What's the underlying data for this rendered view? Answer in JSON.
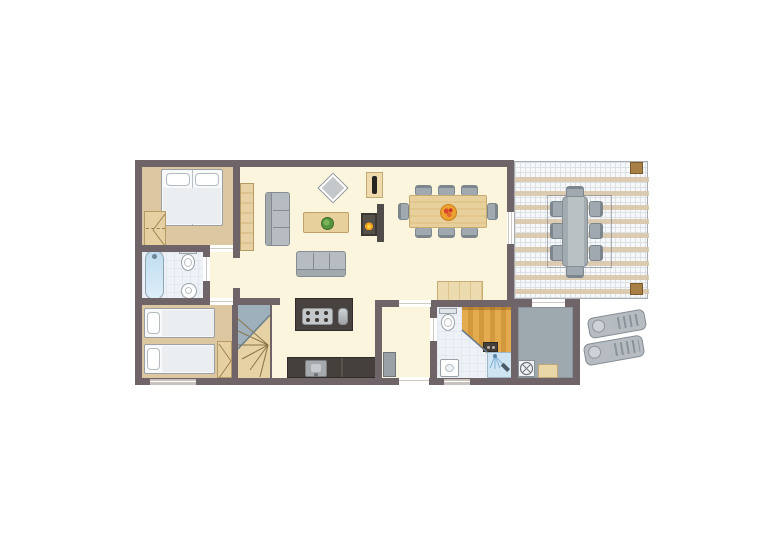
{
  "scene": "holiday-home-floor-plan",
  "visible_text": [],
  "colors": {
    "wall": "#6f6568",
    "floor": "#fcf5dd",
    "floor_tan": "#dcc7a1",
    "wood": "#e6d0a2",
    "wood_dark": "#b79b67",
    "kitchen_dark": "#474140",
    "bath_floor": "#eef2f7",
    "sauna_wood": "#e3aa4e",
    "sauna_wood_dark": "#d3983c",
    "storage_floor": "#9ea8af",
    "terrace_tile": "#f6f8fa",
    "terrace_grid": "#dce1e6",
    "terrace_beam": "#d8c5a6",
    "furn_gray": "#b6bcc1",
    "furn_gray_border": "#858d94",
    "chair_gray": "#9fa9af",
    "table_wood": "#e8d09c",
    "water_blue": "#bfdcef",
    "shower_blue": "#cfe4f3",
    "flame_orange": "#f59d1e",
    "plant_green": "#57923e",
    "fruit_bowl": "#eda12f",
    "post_brown": "#a87f44"
  },
  "rooms": [
    {
      "id": "bedroom-double",
      "floor": "tan"
    },
    {
      "id": "bathroom-main",
      "floor": "tile"
    },
    {
      "id": "corridor",
      "floor": "cream"
    },
    {
      "id": "bedroom-twin",
      "floor": "tan"
    },
    {
      "id": "staircase",
      "floor": "wood"
    },
    {
      "id": "living-room",
      "floor": "cream"
    },
    {
      "id": "kitchen",
      "floor": "cream"
    },
    {
      "id": "dining-area",
      "floor": "cream"
    },
    {
      "id": "entrance-hall",
      "floor": "cream"
    },
    {
      "id": "shower-room",
      "floor": "tile"
    },
    {
      "id": "sauna",
      "floor": "wood"
    },
    {
      "id": "storage-room",
      "floor": "gray"
    },
    {
      "id": "terrace",
      "floor": "tiles-with-pergola-beams"
    }
  ],
  "furniture_icons": [
    "double-bed-icon",
    "wardrobe-icon",
    "bathtub-icon",
    "toilet-icon",
    "washbasin-icon",
    "single-bed-icon",
    "single-bed-icon",
    "closet-icon",
    "winder-stairs-icon",
    "sofa-icon",
    "sofa-icon",
    "coffee-table-plant-icon",
    "side-table-icon",
    "tv-cabinet-icon",
    "fireplace-icon",
    "tall-cabinet-icon",
    "dining-table-fruit-bowl-icon",
    "dining-chair-icon-x8",
    "kitchen-island-hob-icon",
    "kitchen-counter-sink-icon",
    "sideboard-icon",
    "door-leaf-icon",
    "toilet-icon",
    "washbasin-icon",
    "shower-spray-icon",
    "sauna-bench-icon",
    "sauna-stove-icon",
    "washing-machine-icon",
    "storage-box-icon",
    "patio-table-icon",
    "patio-chair-icon-x8",
    "pergola-post-icon",
    "sun-lounger-icon",
    "sun-lounger-icon"
  ]
}
